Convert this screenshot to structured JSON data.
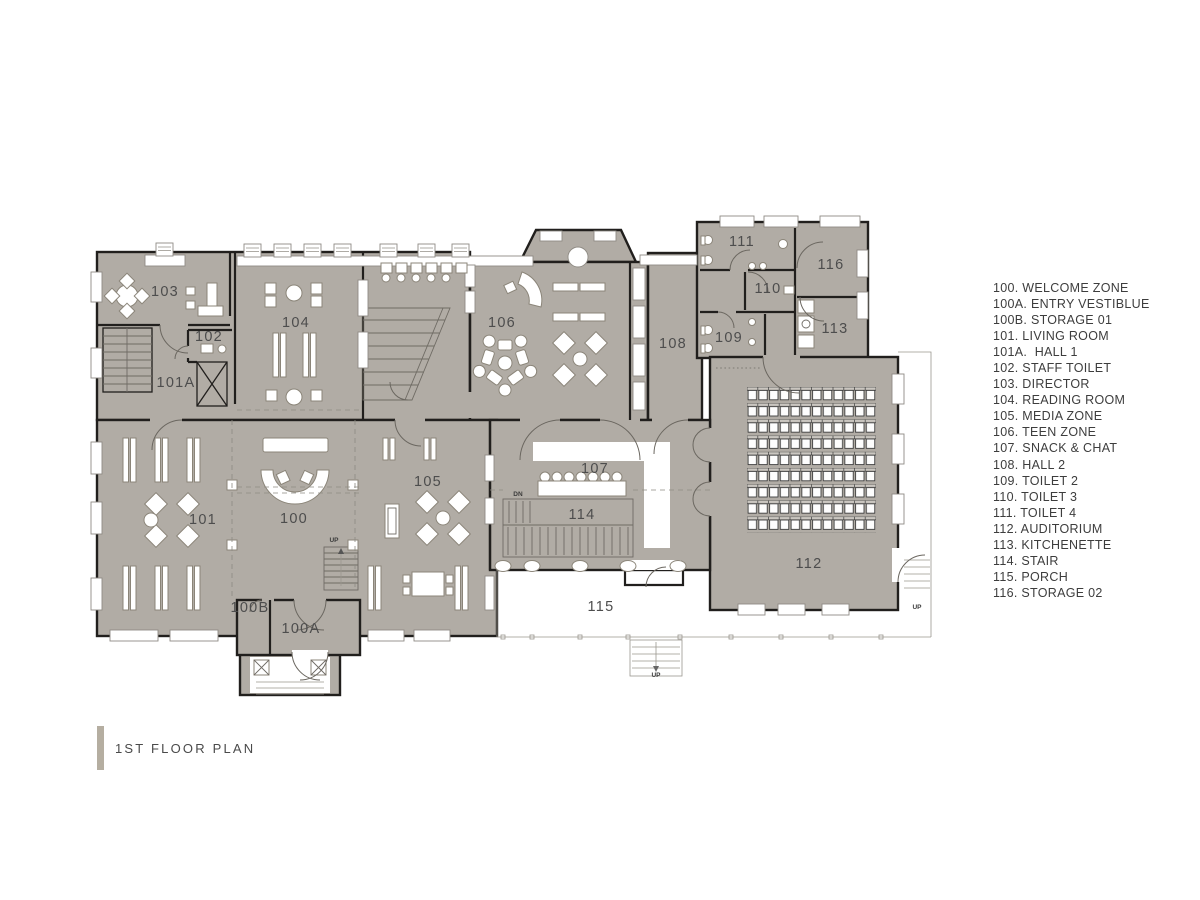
{
  "title_block": {
    "title": "1ST FLOOR PLAN"
  },
  "legend": {
    "items": [
      "100. WELCOME ZONE",
      "100A. ENTRY VESTIBLUE",
      "100B. STORAGE 01",
      "101. LIVING ROOM",
      "101A.  HALL 1",
      "102. STAFF TOILET",
      "103. DIRECTOR",
      "104. READING ROOM",
      "105. MEDIA ZONE",
      "106. TEEN ZONE",
      "107. SNACK & CHAT",
      "108. HALL 2",
      "109. TOILET 2",
      "110. TOILET 3",
      "111. TOILET 4",
      "112. AUDITORIUM",
      "113. KITCHENETTE",
      "114. STAIR",
      "115. PORCH",
      "116. STORAGE 02"
    ]
  },
  "plan": {
    "name": "1st floor plan drawing",
    "room_labels": [
      {
        "id": "103",
        "label": "103",
        "x": 165,
        "y": 296
      },
      {
        "id": "102",
        "label": "102",
        "x": 209,
        "y": 341
      },
      {
        "id": "101A",
        "label": "101A",
        "x": 176,
        "y": 387
      },
      {
        "id": "104",
        "label": "104",
        "x": 296,
        "y": 327
      },
      {
        "id": "106",
        "label": "106",
        "x": 502,
        "y": 327
      },
      {
        "id": "108",
        "label": "108",
        "x": 673,
        "y": 348
      },
      {
        "id": "111",
        "label": "111",
        "x": 742,
        "y": 246
      },
      {
        "id": "116",
        "label": "116",
        "x": 831,
        "y": 269
      },
      {
        "id": "110",
        "label": "110",
        "x": 768,
        "y": 293
      },
      {
        "id": "113",
        "label": "113",
        "x": 835,
        "y": 333
      },
      {
        "id": "109",
        "label": "109",
        "x": 729,
        "y": 342
      },
      {
        "id": "112",
        "label": "112",
        "x": 809,
        "y": 568
      },
      {
        "id": "101",
        "label": "101",
        "x": 203,
        "y": 524
      },
      {
        "id": "100",
        "label": "100",
        "x": 294,
        "y": 523
      },
      {
        "id": "105",
        "label": "105",
        "x": 428,
        "y": 486
      },
      {
        "id": "107",
        "label": "107",
        "x": 595,
        "y": 473
      },
      {
        "id": "114",
        "label": "114",
        "x": 582,
        "y": 519
      },
      {
        "id": "115",
        "label": "115",
        "x": 601,
        "y": 611
      },
      {
        "id": "100B",
        "label": "100B",
        "x": 250,
        "y": 612
      },
      {
        "id": "100A",
        "label": "100A",
        "x": 301,
        "y": 633
      }
    ],
    "direction_labels": [
      {
        "id": "up-entry-stair",
        "label": "UP",
        "x": 334,
        "y": 542
      },
      {
        "id": "dn-stair-114",
        "label": "DN",
        "x": 518,
        "y": 496
      },
      {
        "id": "up-porch-stair",
        "label": "UP",
        "x": 656,
        "y": 677
      },
      {
        "id": "up-side-stair",
        "label": "UP",
        "x": 917,
        "y": 609
      }
    ],
    "auditorium_seats": {
      "rows": 9,
      "cols": 12
    }
  },
  "colors": {
    "floor_fill": "#b1aca5",
    "wall": "#211f1d",
    "accent_bar": "#b5aea1",
    "label": "#4d4d4d"
  }
}
